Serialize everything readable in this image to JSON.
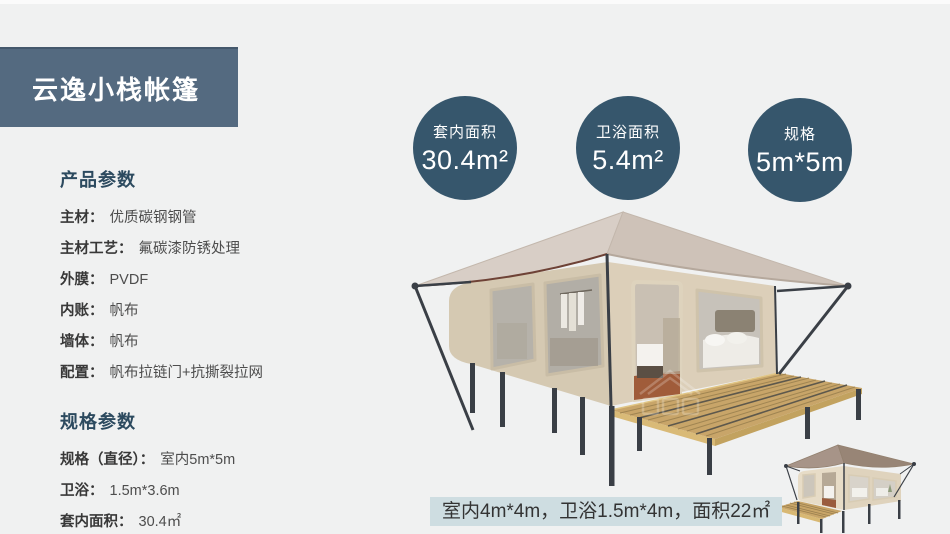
{
  "title_banner": {
    "text": "云逸小栈帐篷"
  },
  "product_params": {
    "header": "产品参数",
    "rows": [
      {
        "label": "主材：",
        "value": "优质碳钢钢管"
      },
      {
        "label": "主材工艺：",
        "value": "氟碳漆防锈处理"
      },
      {
        "label": "外膜：",
        "value": "PVDF"
      },
      {
        "label": "内账：",
        "value": "帆布"
      },
      {
        "label": "墙体：",
        "value": "帆布"
      },
      {
        "label": "配置：",
        "value": "帆布拉链门+抗撕裂拉网"
      }
    ]
  },
  "spec_params": {
    "header": "规格参数",
    "rows": [
      {
        "label": "规格（直径）：",
        "value": "室内5m*5m"
      },
      {
        "label": "卫浴：",
        "value": "1.5m*3.6m"
      },
      {
        "label": "套内面积：",
        "value": "30.4㎡"
      }
    ]
  },
  "stat_circles": [
    {
      "label": "套内面积",
      "value": "30.4m²"
    },
    {
      "label": "卫浴面积",
      "value": "5.4m²"
    },
    {
      "label": "规格",
      "value": "5m*5m"
    }
  ],
  "caption": {
    "text": "室内4m*4m，卫浴1.5m*4m，面积22㎡"
  },
  "colors": {
    "background": "#f0f1f1",
    "banner_bg": "#546a80",
    "circle_bg": "#36566c",
    "header_text": "#2c4a5f",
    "caption_bg": "#cedde1",
    "roof": "#d8cec6",
    "canvas_wall": "#d5c9b2",
    "deck_wood": "#c8a569",
    "metal_frame": "#3a3f46"
  }
}
